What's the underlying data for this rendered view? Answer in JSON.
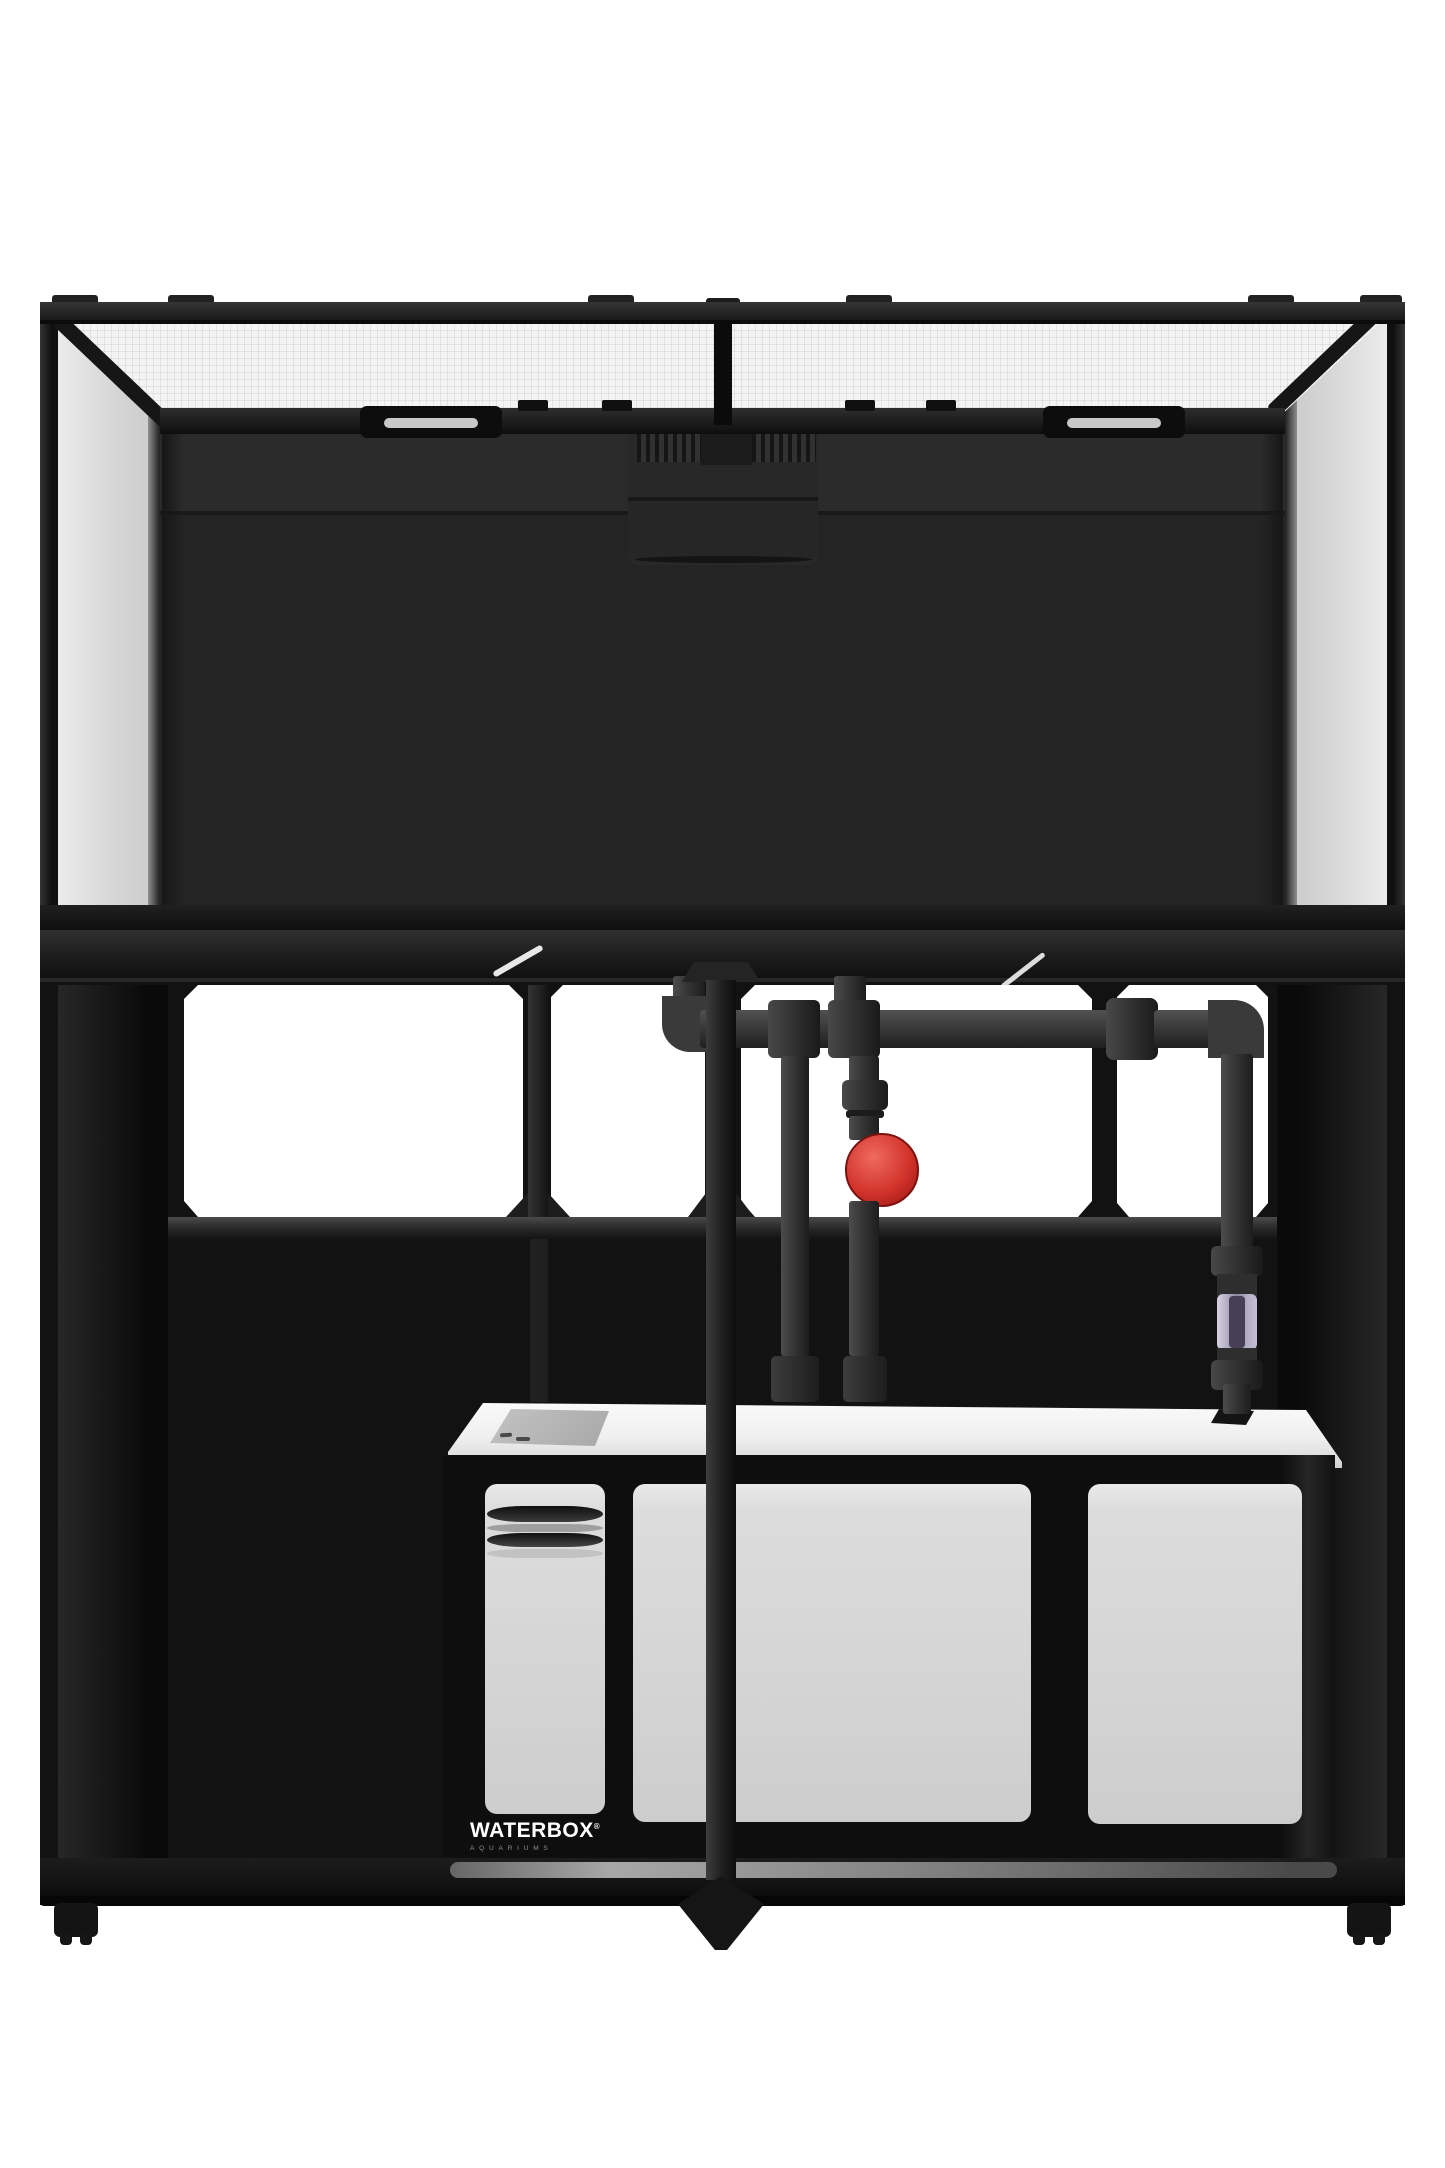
{
  "meta": {
    "type": "product-photo",
    "subject": "Waterbox aquarium system, front view: rimless glass tank with mesh screen lids on a black stand with white sump and drain plumbing",
    "canvas": {
      "width": 1445,
      "height": 2168
    },
    "background_color": "#ffffff"
  },
  "brand": {
    "logo_text": "WATERBOX",
    "registered_mark": "®",
    "logo_subtext": "AQUARIUMS"
  },
  "colors": {
    "frame_black": "#141414",
    "rim_highlight": "#323232",
    "glass": "#d7d7d7",
    "mesh_lid": "#f3f3f3",
    "tank_interior": "#262626",
    "pipe_gray": "#3c3c3c",
    "valve_handle_red": "#d2342c",
    "check_valve_window": "#b9b3c8",
    "sump_window": "#d4d4d4",
    "sump_top": "#f2f2f2",
    "floor_highlight": "#9a9a9a",
    "logo_text_color": "#ffffff",
    "logo_subtext_color": "#909090"
  }
}
